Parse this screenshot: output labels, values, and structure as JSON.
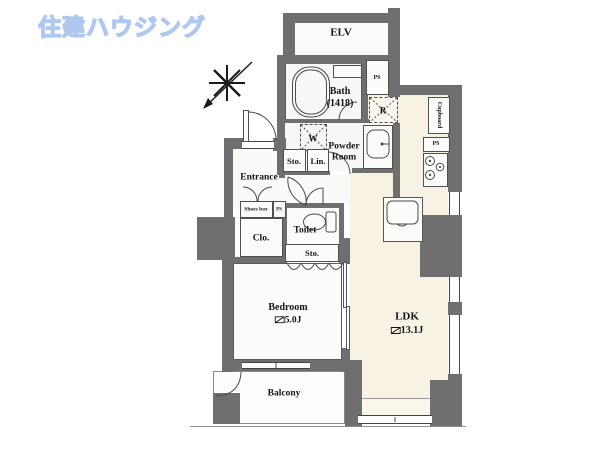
{
  "logo": {
    "text": "住建ハウジング"
  },
  "colors": {
    "wall": "#6f6f6f",
    "ldk_floor": "#f7f2e4",
    "logo_blue": "#afc8f0"
  },
  "plan": {
    "elv": "ELV",
    "bath_name": "Bath",
    "bath_size": "(1418)",
    "ps": "PS",
    "fridge": "R",
    "washer": "W",
    "cupboard": "Cupboard",
    "powder_line1": "Powder",
    "powder_line2": "Room",
    "sto": "Sto.",
    "lin": "Lin.",
    "entrance": "Entrance",
    "shoes_box": "Shoes box",
    "clo": "Clo.",
    "toilet": "Toilet",
    "bedroom_name": "Bedroom",
    "bedroom_size": "5.0J",
    "ldk_name": "LDK",
    "ldk_size": "13.1J",
    "balcony": "Balcony"
  }
}
